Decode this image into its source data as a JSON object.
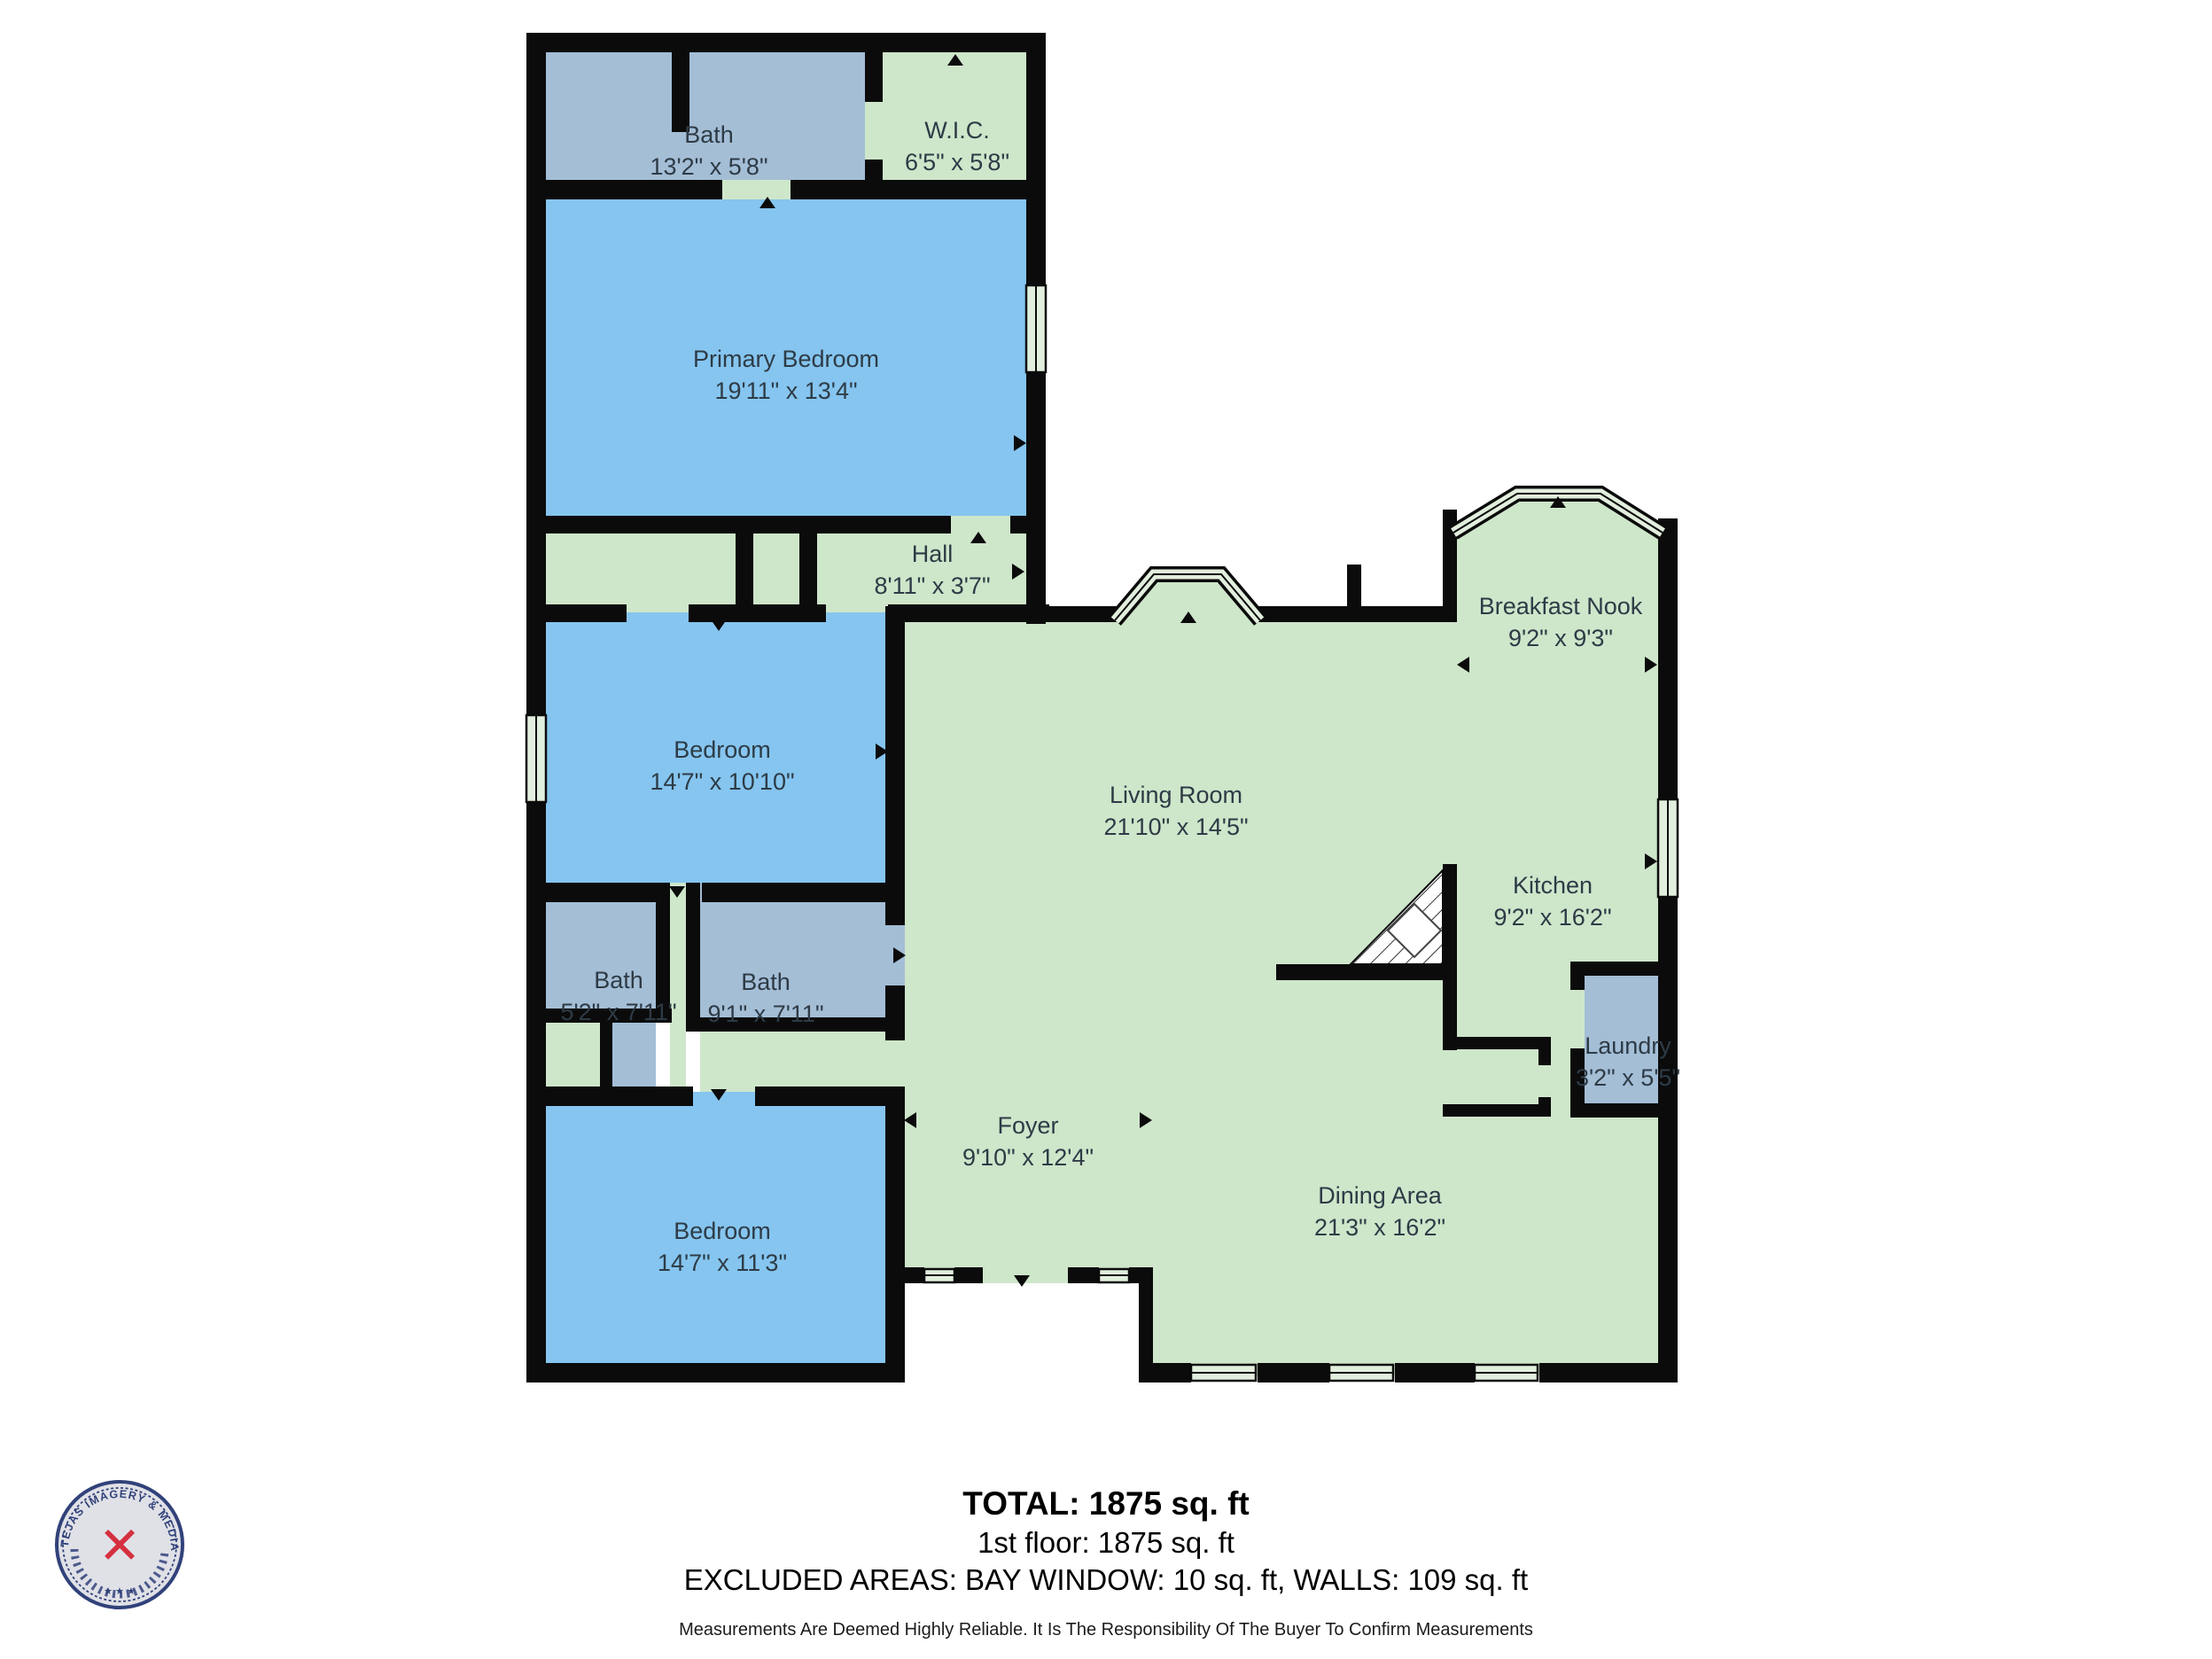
{
  "floorplan": {
    "rooms": [
      {
        "id": "bath_top",
        "name": "Bath",
        "dims": "13'2\" x 5'8\""
      },
      {
        "id": "wic",
        "name": "W.I.C.",
        "dims": "6'5\" x 5'8\""
      },
      {
        "id": "primary_bedroom",
        "name": "Primary Bedroom",
        "dims": "19'11\" x 13'4\""
      },
      {
        "id": "hall",
        "name": "Hall",
        "dims": "8'11\" x 3'7\""
      },
      {
        "id": "breakfast_nook",
        "name": "Breakfast Nook",
        "dims": "9'2\" x 9'3\""
      },
      {
        "id": "bedroom_mid",
        "name": "Bedroom",
        "dims": "14'7\" x 10'10\""
      },
      {
        "id": "living_room",
        "name": "Living Room",
        "dims": "21'10\" x 14'5\""
      },
      {
        "id": "kitchen",
        "name": "Kitchen",
        "dims": "9'2\" x 16'2\""
      },
      {
        "id": "bath_small",
        "name": "Bath",
        "dims": "5'2\" x 7'11\""
      },
      {
        "id": "bath_hall",
        "name": "Bath",
        "dims": "9'1\" x 7'11\""
      },
      {
        "id": "laundry",
        "name": "Laundry",
        "dims": "3'2\" x 5'5\""
      },
      {
        "id": "foyer",
        "name": "Foyer",
        "dims": "9'10\" x 12'4\""
      },
      {
        "id": "bedroom_bottom",
        "name": "Bedroom",
        "dims": "14'7\" x 11'3\""
      },
      {
        "id": "dining_area",
        "name": "Dining Area",
        "dims": "21'3\" x 16'2\""
      }
    ],
    "colors": {
      "bedroom_fill": "#85C5EF",
      "bath_fill": "#A4BED6",
      "living_fill": "#CEE6CA",
      "window_fill": "#E3EFDE",
      "wall": "#0B0B0B",
      "label_text": "#2E3B46"
    }
  },
  "summary": {
    "total": "TOTAL: 1875 sq. ft",
    "first_floor": "1st floor: 1875 sq. ft",
    "excluded": "EXCLUDED AREAS: BAY WINDOW: 10 sq. ft, WALLS: 109 sq. ft"
  },
  "disclaimer": "Measurements Are Deemed Highly Reliable. It Is The Responsibility Of The Buyer To Confirm Measurements",
  "logo": {
    "seal_text": "TEJAS IMAGERY & MEDIA SERVICES",
    "stars": "★ ★ ★",
    "center_icon": "✕",
    "navy": "#31427A",
    "red": "#D5303F"
  }
}
